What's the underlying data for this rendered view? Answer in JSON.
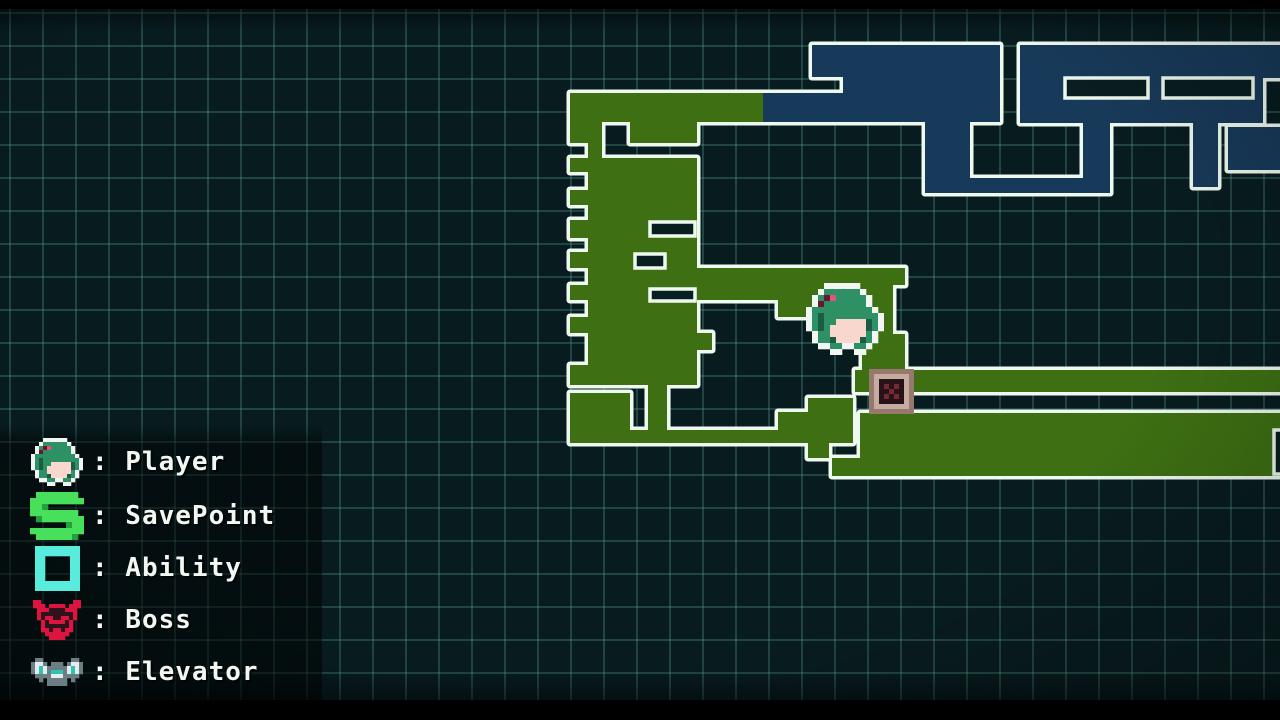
{
  "screen": {
    "title": "Game map screen"
  },
  "colors": {
    "bg": "#081c20",
    "grid_line": "#58a290",
    "outline": "#eefaf0",
    "room_green": "#3e7013",
    "room_blue": "#183a5a",
    "hole": "#081e20",
    "legend_text": "#f2f7f2",
    "panel": "rgba(0,0,0,0.5)"
  },
  "legend": {
    "rows": [
      {
        "icon": "player",
        "label": ": Player"
      },
      {
        "icon": "savepoint",
        "label": ": SavePoint"
      },
      {
        "icon": "ability",
        "label": ": Ability"
      },
      {
        "icon": "boss",
        "label": ": Boss"
      },
      {
        "icon": "elevator",
        "label": ": Elevator"
      }
    ]
  },
  "map": {
    "shapes": [
      {
        "c": "g",
        "r": [
          570,
          93,
          193,
          29
        ]
      },
      {
        "c": "g",
        "r": [
          570,
          118,
          32,
          25
        ]
      },
      {
        "c": "g",
        "r": [
          630,
          118,
          67,
          25
        ]
      },
      {
        "c": "g",
        "r": [
          588,
          143,
          14,
          15
        ]
      },
      {
        "c": "g",
        "r": [
          570,
          158,
          127,
          14
        ]
      },
      {
        "c": "g",
        "r": [
          588,
          172,
          109,
          18
        ]
      },
      {
        "c": "g",
        "r": [
          570,
          190,
          127,
          15
        ]
      },
      {
        "c": "g",
        "r": [
          588,
          205,
          109,
          15
        ]
      },
      {
        "c": "g",
        "r": [
          570,
          220,
          127,
          18
        ]
      },
      {
        "c": "g",
        "r": [
          588,
          238,
          109,
          14
        ]
      },
      {
        "c": "g",
        "r": [
          570,
          252,
          127,
          16
        ]
      },
      {
        "c": "g",
        "r": [
          588,
          268,
          317,
          17
        ]
      },
      {
        "c": "g",
        "r": [
          570,
          285,
          127,
          15
        ]
      },
      {
        "c": "g",
        "r": [
          588,
          300,
          109,
          17
        ]
      },
      {
        "c": "g",
        "r": [
          570,
          317,
          127,
          16
        ]
      },
      {
        "c": "g",
        "r": [
          588,
          333,
          124,
          17
        ]
      },
      {
        "c": "g",
        "r": [
          588,
          350,
          109,
          15
        ]
      },
      {
        "c": "g",
        "r": [
          570,
          365,
          127,
          20
        ]
      },
      {
        "c": "g",
        "r": [
          648,
          385,
          19,
          45
        ]
      },
      {
        "c": "g",
        "r": [
          570,
          393,
          60,
          37
        ]
      },
      {
        "c": "g",
        "r": [
          570,
          430,
          238,
          13
        ]
      },
      {
        "c": "g",
        "r": [
          808,
          443,
          21,
          15
        ]
      },
      {
        "c": "g",
        "r": [
          778,
          412,
          30,
          31
        ]
      },
      {
        "c": "g",
        "r": [
          808,
          398,
          45,
          45
        ]
      },
      {
        "c": "g",
        "r": [
          855,
          370,
          437,
          22
        ]
      },
      {
        "c": "g",
        "r": [
          693,
          268,
          85,
          32
        ]
      },
      {
        "c": "g",
        "r": [
          778,
          268,
          60,
          49
        ]
      },
      {
        "c": "g",
        "r": [
          838,
          268,
          55,
          66
        ]
      },
      {
        "c": "g",
        "r": [
          893,
          268,
          12,
          15
        ]
      },
      {
        "c": "g",
        "r": [
          862,
          334,
          43,
          38
        ]
      },
      {
        "c": "g",
        "p": [
          [
            860,
            413
          ],
          [
            1292,
            413
          ],
          [
            1292,
            476
          ],
          [
            832,
            476
          ],
          [
            832,
            458
          ],
          [
            860,
            458
          ]
        ]
      },
      {
        "c": "b",
        "p": [
          [
            763,
            93
          ],
          [
            843,
            93
          ],
          [
            843,
            77
          ],
          [
            812,
            77
          ],
          [
            812,
            45
          ],
          [
            1000,
            45
          ],
          [
            1000,
            122
          ],
          [
            970,
            122
          ],
          [
            970,
            193
          ],
          [
            925,
            193
          ],
          [
            925,
            122
          ],
          [
            763,
            122
          ]
        ]
      },
      {
        "c": "b",
        "r": [
          925,
          178,
          185,
          15
        ]
      },
      {
        "c": "b",
        "p": [
          [
            1020,
            45
          ],
          [
            1292,
            45
          ],
          [
            1292,
            78
          ],
          [
            1263,
            78
          ],
          [
            1263,
            123
          ],
          [
            1218,
            123
          ],
          [
            1218,
            187
          ],
          [
            1193,
            187
          ],
          [
            1193,
            123
          ],
          [
            1110,
            123
          ],
          [
            1110,
            193
          ],
          [
            1083,
            193
          ],
          [
            1083,
            123
          ],
          [
            1020,
            123
          ]
        ]
      },
      {
        "c": "b",
        "r": [
          1228,
          127,
          64,
          43
        ]
      }
    ],
    "holes": [
      [
        650,
        222,
        45,
        14
      ],
      [
        635,
        254,
        30,
        14
      ],
      [
        650,
        289,
        45,
        12
      ],
      [
        1274,
        430,
        18,
        44
      ],
      [
        1065,
        78,
        83,
        20
      ],
      [
        1163,
        78,
        90,
        20
      ]
    ]
  },
  "sprites": {
    "player_marker": {
      "x": 806,
      "y": 283,
      "scale": 6,
      "palette": {
        "W": "#f2f6f2",
        "G": "#2e9166",
        "D": "#1b5c44",
        "F": "#f8d8ce",
        "P": "#6e1430",
        "p": "#e0557a"
      },
      "rows": [
        "...WWWWWW....",
        "..WGGGGGGW...",
        ".WGPpGGGGGW..",
        ".WPGGGGGGGW..",
        "WGGGGGGGGGGW.",
        "WGDGGGGGGGGGW",
        "WGDGGFFFFFDGW",
        "WGDGFFFFFFDGW",
        ".WGGFFFFFFGW.",
        ".WGGDFFFFDGW.",
        "..WWGGWWGGW..",
        "....WW..WW..."
      ]
    },
    "boss_room_marker": {
      "x": 869,
      "y": 369,
      "scale": 5,
      "palette": {
        "f": "#96786c",
        "F": "#c6aca0",
        "k": "#281418",
        "r": "#782832"
      },
      "rows": [
        "fffffffff",
        "fFFFFFFFf",
        "fFkkkkkFf",
        "fFkrkrkFf",
        "fFkkrkkFf",
        "fFkrkrkFf",
        "fFkkkkkFf",
        "fFFFFFFFf",
        "fffffffff"
      ]
    }
  },
  "icons": {
    "player": {
      "scale": 4,
      "palette": {
        "W": "#f2f6f2",
        "G": "#2e9166",
        "D": "#1b5c44",
        "F": "#f8d8ce",
        "P": "#6e1430",
        "p": "#e0557a"
      },
      "rows": [
        "...WWWWWW....",
        "..WGGGGGGW...",
        ".WGPpGGGGGW..",
        ".WPGGGGGGGW..",
        "WGGGGGGGGGGW.",
        "WGDGGGGGGGGGW",
        "WGDGGFFFFFDGW",
        "WGDGFFFFFFDGW",
        ".WGGFFFFFFGW.",
        ".WGGDFFFFDGW.",
        "..WWGGWWGGW..",
        "....WW..WW..."
      ]
    },
    "savepoint": {
      "scale": 6,
      "palette": {
        "G": "#46e05a",
        "d": "#23a03c"
      },
      "rows": [
        ".GGGGGGG.",
        "GGGGGGGGG",
        "GGd......",
        "GGGGGGGG.",
        ".dGGGGGGG",
        "......dGG",
        "GGGGGGGGG",
        ".GGGGGGd."
      ]
    },
    "ability": {
      "scale": 5,
      "palette": {
        "C": "#58ecdc"
      },
      "rows": [
        "CCCCCCCCC",
        "CCCCCCCCC",
        "CC.....CC",
        "CC.....CC",
        "CC.....CC",
        "CC.....CC",
        "CC.....CC",
        "CCCCCCCCC",
        "CCCCCCCCC"
      ]
    },
    "boss": {
      "scale": 4,
      "palette": {
        "R": "#dc1440",
        "k": "#30121c"
      },
      "rows": [
        "RR........RR",
        "RRR.RRRR.RRR",
        ".RRRkkkkRRR.",
        ".RkkkkkkkkR.",
        ".RkRRkkRRkR.",
        "..RkRRRRkR..",
        "..RkkkkkkR..",
        "..RRkRRkRR..",
        "...RRRRRR...",
        "....RRRR...."
      ]
    },
    "elevator": {
      "scale": 4,
      "palette": {
        "d": "#6a7e84",
        "L": "#e6ecec",
        "T": "#2ec4b4",
        "k": "#223034"
      },
      "rows": [
        ".dd.......dd.",
        "dLLd.ddd.dLLd",
        "dLTLdddddLTLd",
        "dLTLdTTTdLTLd",
        ".ddddLLLdddd.",
        "..d.ddddd.d..",
        "....ddddd...."
      ]
    }
  }
}
